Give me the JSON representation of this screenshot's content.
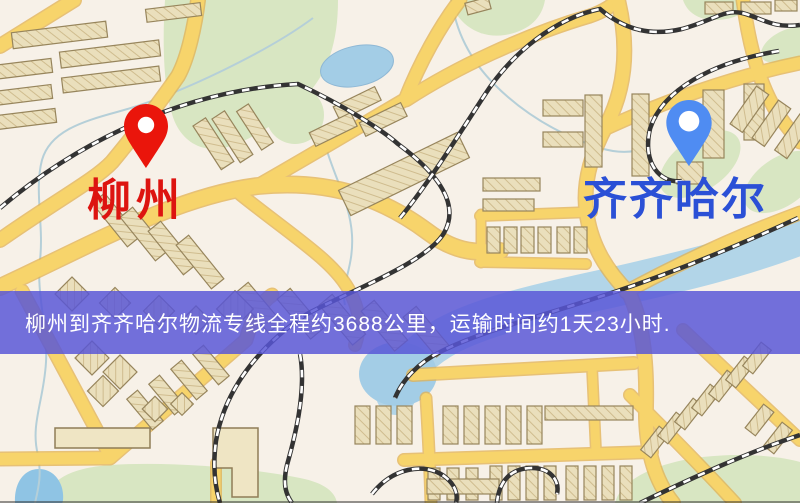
{
  "map": {
    "origin": {
      "label": "柳州",
      "label_color": "#dd1410",
      "pin_color": "#ea150b"
    },
    "destination": {
      "label": "齐齐哈尔",
      "label_color": "#2b50d6",
      "pin_color": "#4f8cf2"
    }
  },
  "banner": {
    "text": "柳州到齐齐哈尔物流专线全程约3688公里，运输时间约1天23小时.",
    "background_color": "#5856d7",
    "text_color": "#ffffff",
    "distance_km": 3688,
    "transit_time": "1天23小时"
  },
  "palette": {
    "map_background": "#f7f1e8",
    "road_fill": "#f7d46b",
    "road_casing": "#e2b151",
    "park_green": "#d8e6c2",
    "water_blue": "#9fcbe4",
    "railway_dark": "#333333",
    "building_tan": "#eadfbc"
  }
}
